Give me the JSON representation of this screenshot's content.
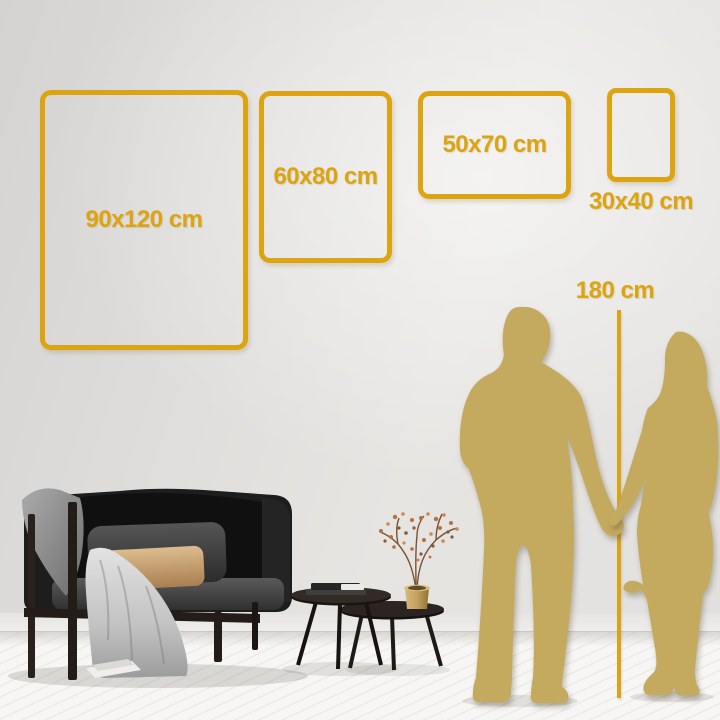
{
  "frames": [
    {
      "id": "90x120",
      "label": "90x120 cm"
    },
    {
      "id": "60x80",
      "label": "60x80 cm"
    },
    {
      "id": "50x70",
      "label": "50x70 cm"
    },
    {
      "id": "30x40",
      "label": "30x40 cm"
    }
  ],
  "height_ruler": {
    "label": "180 cm"
  },
  "colors": {
    "accent_gold": "#DCA411",
    "silhouette_gold": "#C4AA5E"
  }
}
